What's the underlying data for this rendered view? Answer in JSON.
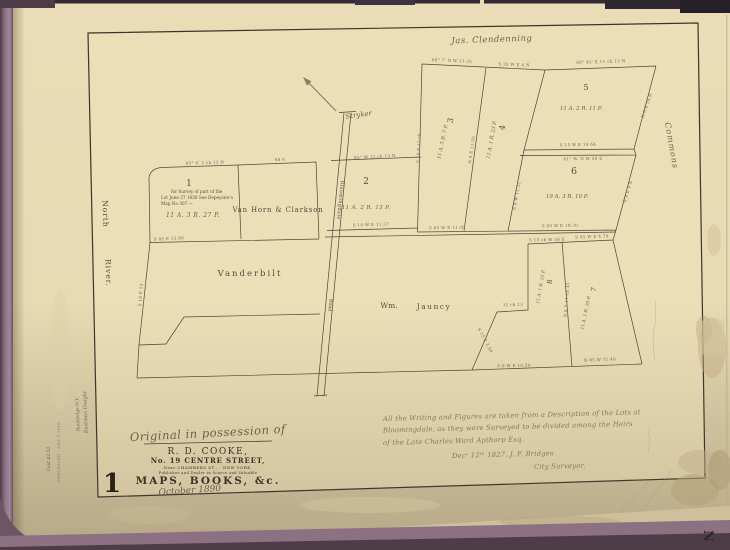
{
  "map": {
    "neighbors": {
      "clendenning": "Jas. Clendenning",
      "stryker": "Stryker",
      "commons": "Commons"
    },
    "water": {
      "north": "North",
      "river": "River."
    },
    "road": {
      "name": "Bloomingdale",
      "word": "Road"
    },
    "owners": {
      "van_horn": "Van Horn & Clarkson",
      "vanderbilt": "Vanderbilt",
      "jauncey_first": "Wm.",
      "jauncey_last": "Jauncy"
    },
    "parcels": {
      "p1": {
        "number": "1",
        "note1": "for Survey of part of the",
        "note2": "Lot June 27 1836 See Depeyster's",
        "note3": "Map No 307 —",
        "area": "11 A. 3 R. 27 P."
      },
      "p2": {
        "number": "2",
        "area": "11 A. 2 R. 13 P."
      },
      "p3": {
        "number": "3",
        "area": "11 A. 5 R. 7 P."
      },
      "p4": {
        "number": "4",
        "area": "11 A. 1 R. 23 P."
      },
      "p5": {
        "number": "5",
        "area": "11 A. 2 R. 11 P."
      },
      "p6": {
        "number": "6",
        "area": "19 A. 3 R. 10 P."
      },
      "p7": {
        "number": "7",
        "area": "11 A. 1 R. 30 P."
      },
      "p8": {
        "number": "8",
        "area": "11 A. 1 R. 10 P."
      }
    },
    "bearings": [
      "85° 6' 2 ch 13 N",
      "68 6",
      "85° W 11 ch 13 N",
      "66° 7' N W 11 ch",
      "S 35 W E 4 N",
      "66° 45' E 11 ch 13 N",
      "S 15 W E 19.64",
      "61° W. N W 58 E",
      "S 85 W E 19.30",
      "S 10 W E 11.37",
      "S 85 E 13.80",
      "S 85 W E 11 ch",
      "S 15 ch W 58 E",
      "S 85 W E 4.70",
      "11 ch 13",
      "S 15 E 2.50",
      "S 8 W E 10.50",
      "N 85 W 11.40",
      "N 8 E 11 ch 45",
      "N 8 E 10 N",
      "N 8 E 4 N",
      "S 10 E 11 ch",
      "N 9 E 11.50",
      "S 9 W 11.52",
      "S 18 E 13"
    ]
  },
  "imprint": {
    "possession": "Original in possession of",
    "name": "R. D. COOKE,",
    "street": "No. 19 CENTRE STREET,",
    "near": "Near CHAMBERS ST.,  -  NEW YORK.",
    "dealer": "Publisher and Dealer in Scarce and Valuable",
    "wares": "MAPS, BOOKS, &c.",
    "date": "October 1890",
    "sheet_number": "1"
  },
  "survey_note": {
    "line1": "All the Writing and Figures are taken from a Description of the Lots at",
    "line2": "Bloomingdale, as they were Surveyed to be divided among the Heirs",
    "line3": "of the Late Charles Ward Apthorp Esq.",
    "line4": "Decʳ 12ᵗʰ 1827.   J. F. Bridges",
    "line5": "City Surveyor."
  },
  "margin": {
    "pencil1": "Eastman Dwight",
    "pencil2": "Rockledge N.Y.",
    "stamp": "PURCHASED · AUG 7 1916",
    "cost": "Cost $2.50",
    "next_page_letter": "N"
  }
}
